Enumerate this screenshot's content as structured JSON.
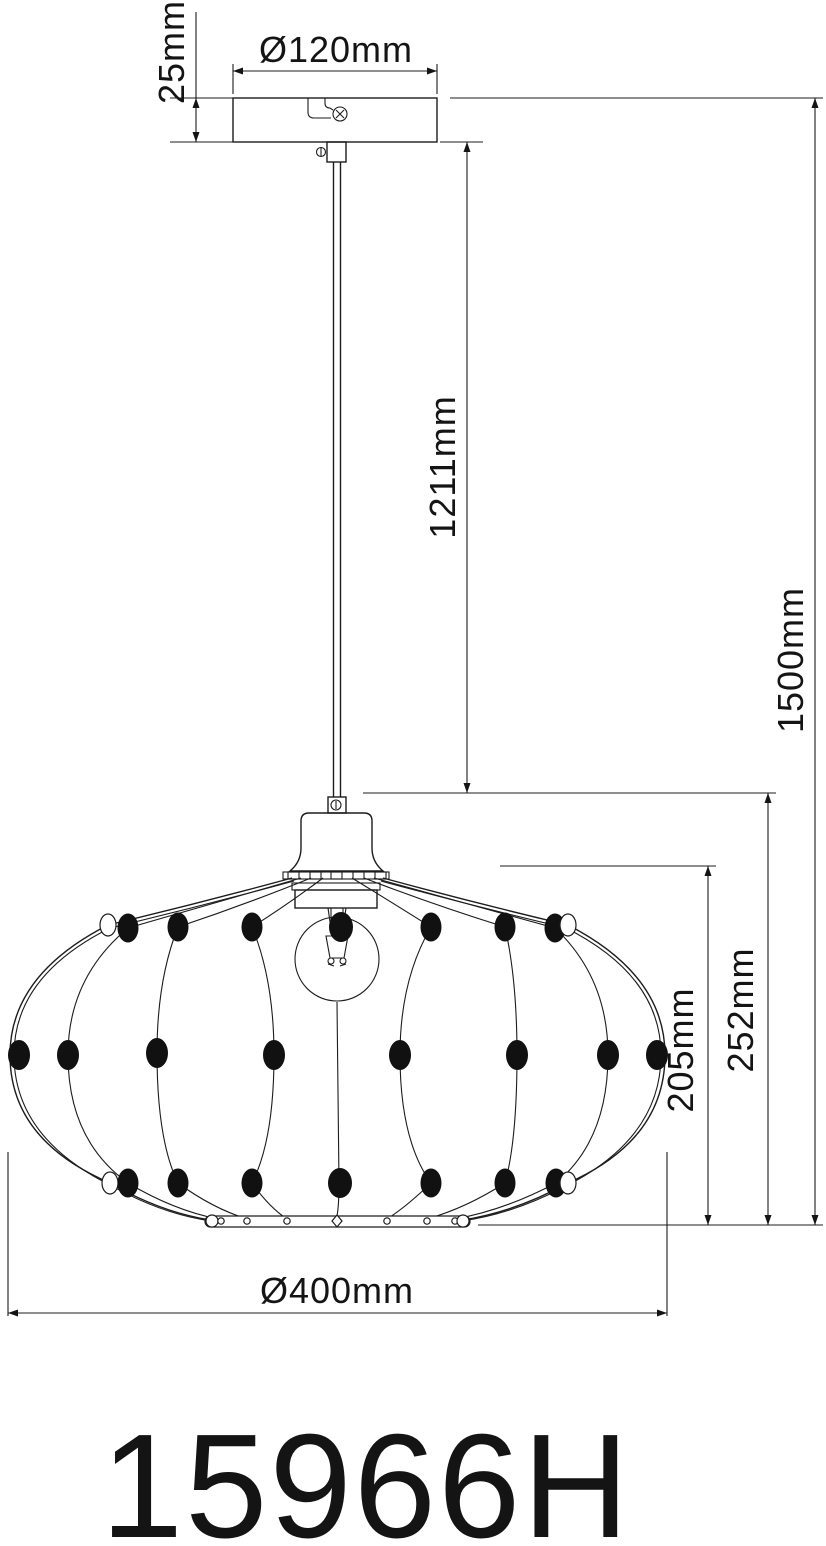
{
  "drawing": {
    "title_model": "15966H",
    "dimensions": {
      "canopy_height": "25mm",
      "canopy_diameter": "Ø120mm",
      "rod_drop": "1211mm",
      "overall_height": "1500mm",
      "shade_cage_height": "205mm",
      "shade_total_height": "252mm",
      "shade_diameter": "Ø400mm"
    },
    "colors": {
      "line": "#1c1c1c",
      "background": "#ffffff",
      "bead_fill": "#111111"
    },
    "parts": {
      "canopy": "ceiling canopy",
      "rod": "suspension rod",
      "cap": "shade top cap",
      "bulb": "light bulb",
      "cage": "wire cage shade",
      "beads": "decorative beads",
      "bottom_ring": "bottom ring"
    }
  }
}
